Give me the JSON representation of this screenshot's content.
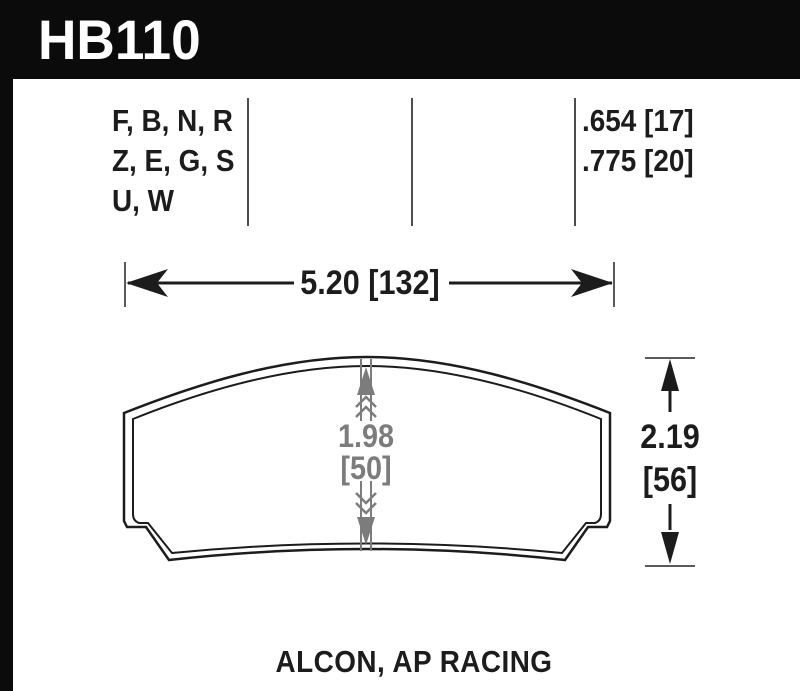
{
  "header": {
    "part_number": "HB110",
    "bg_color": "#0b0b0b",
    "text_color": "#ffffff"
  },
  "spec_table": {
    "compound_codes": [
      "F, B, N, R",
      "Z, E, G, S",
      "U, W"
    ],
    "thickness_values": [
      ".654 [17]",
      ".775 [20]"
    ]
  },
  "dimensions": {
    "pad_width": "5.20 [132]",
    "center_thickness_in": "1.98",
    "center_thickness_mm": "[50]",
    "pad_height_in": "2.19",
    "pad_height_mm": "[56]"
  },
  "footer": {
    "applications": "ALCON, AP RACING"
  },
  "colors": {
    "line_black": "#1c1c1c",
    "divider_gray": "#4d4d4d",
    "tick_gray": "#5a5a5a",
    "arrow_gray": "#7c7c7c"
  }
}
